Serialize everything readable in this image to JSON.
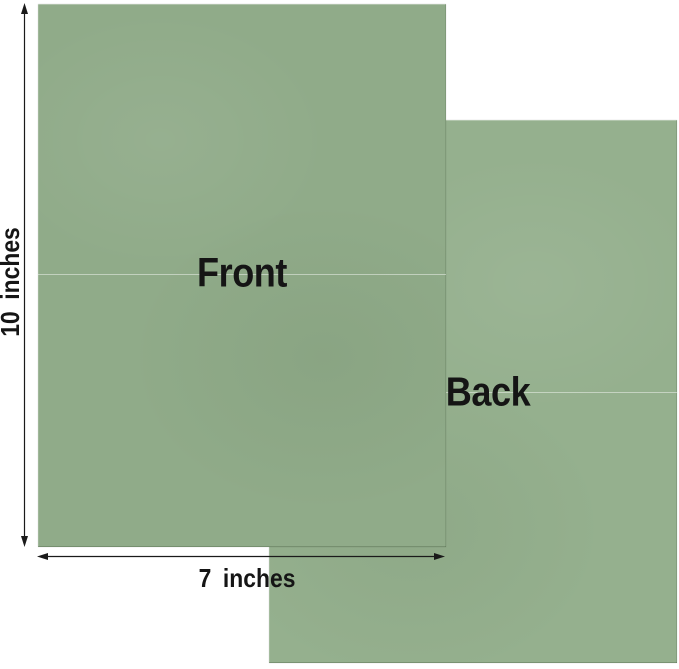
{
  "image": {
    "type": "product-dimension-diagram",
    "background_color": "#ffffff",
    "annotation_text_color": "#151515",
    "arrow_color": "#1a1a1a"
  },
  "sheets": {
    "front": {
      "label": "Front",
      "color": "#90ab89",
      "fold_line_color": "#c2d2b8"
    },
    "back": {
      "label": "Back",
      "color": "#95b08e",
      "fold_line_color": "#c2d2b8"
    }
  },
  "dimensions": {
    "height": {
      "label": "10 inches"
    },
    "width": {
      "label": "7 inches"
    }
  }
}
